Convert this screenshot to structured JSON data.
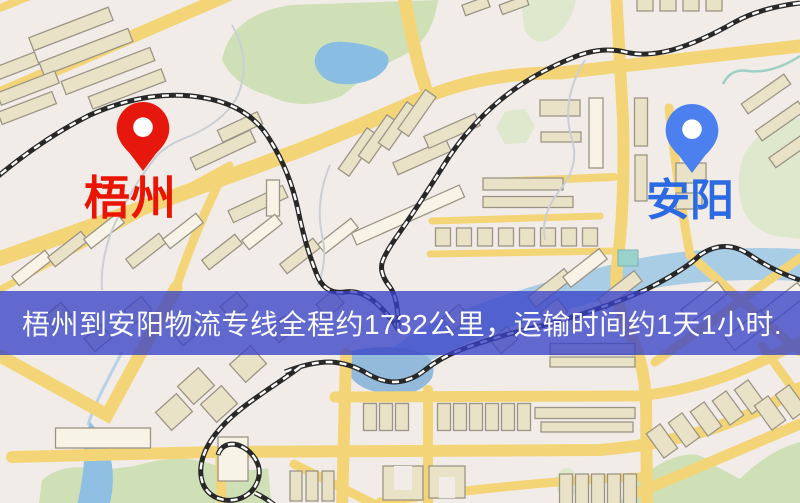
{
  "banner": {
    "text": "梧州到安阳物流专线全程约1732公里，运输时间约1天1小时."
  },
  "markers": {
    "origin": {
      "label": "梧州"
    },
    "destination": {
      "label": "安阳"
    }
  },
  "colors": {
    "background": "#f2ece9",
    "road": "#f3d577",
    "railway": "#282828",
    "building": "#eae2c6",
    "park_green": "#cfe0b6",
    "water": "#8abde2",
    "banner_bg": "rgba(56,66,198,0.78)",
    "banner_text": "#fafafa",
    "origin_label": "#ea1403",
    "destination_label": "#2c6ae2",
    "origin_pin": "#e6170c",
    "destination_pin": "#4b80ee"
  }
}
